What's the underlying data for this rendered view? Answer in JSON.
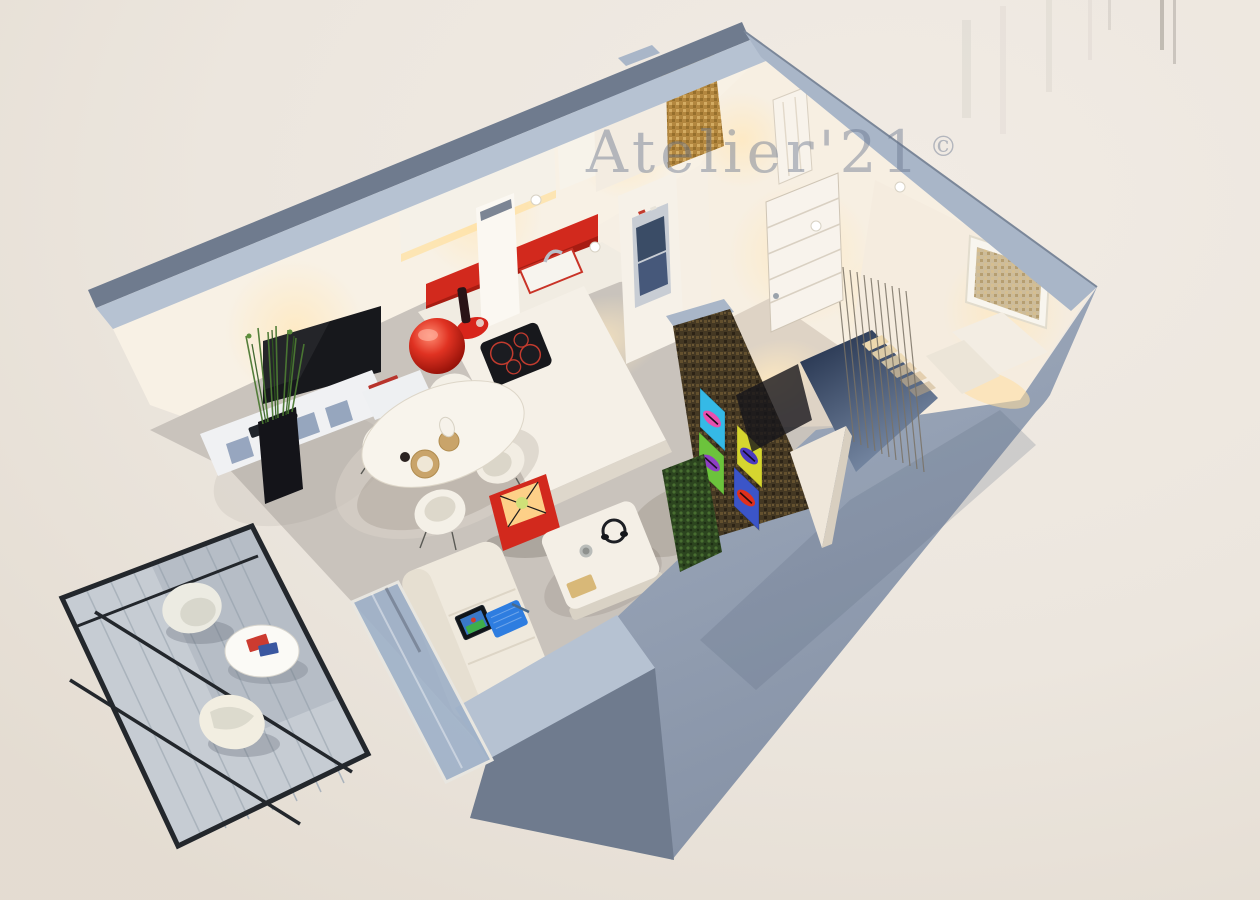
{
  "meta": {
    "type": "3d-apartment-floor-plan-render",
    "view": "axonometric-cutaway-top-down"
  },
  "watermark": {
    "text": "Atelier'21",
    "symbol": "©"
  },
  "palette": {
    "background": "#ede7df",
    "wall_top": "#a9b6c8",
    "wall_top_light": "#b6c2d2",
    "wall_gray": "#96a2b4",
    "wall_exterior": "#6f7b8e",
    "interior_wall": "#f6efe4",
    "floor": "#c9c3bc",
    "floor_warm": "#ded3c5",
    "accent_red": "#d2291d",
    "tv_black": "#17181c",
    "mosaic_gold": "#b3873f",
    "feature_wall": "#443823",
    "green_wall": "#2c451f",
    "stair_dark": "#26344e",
    "glass": "#9db0c8",
    "laptop_blue": "#2e7de0",
    "balcony_frame": "#23272c",
    "balcony_deck": "#c6ccd3",
    "watermark": "rgba(104,117,141,0.45)"
  },
  "art": {
    "name": "pop-art-lips-quadriptych",
    "lips_panels": [
      {
        "bg": "#35b9e6",
        "lips": "#e84fae"
      },
      {
        "bg": "#d6d52f",
        "lips": "#4b39c0"
      },
      {
        "bg": "#6cc33c",
        "lips": "#8e3fc4"
      },
      {
        "bg": "#3b55c8",
        "lips": "#e0301c"
      }
    ]
  },
  "apartment": {
    "rooms": [
      {
        "name": "kitchen",
        "features": [
          "white-upper-cabinets",
          "red-backsplash",
          "sink-with-chrome-faucet",
          "white-chimney-hood",
          "built-in-oven",
          "induction-cooktop",
          "island-counter",
          "red-ball-pendant-lamp",
          "wine-bottle-and-tray",
          "ceiling-spotlights"
        ]
      },
      {
        "name": "living-dining",
        "features": [
          "wall-mounted-tv",
          "white-media-console",
          "espresso-set",
          "books",
          "reed-plant-black-planter",
          "oval-dining-table",
          "four-white-shell-chairs",
          "place-settings",
          "red-cube-floor-lamp",
          "white-sofa",
          "laptop",
          "pen",
          "white-coffee-table",
          "headphones",
          "mug",
          "gold-notebook"
        ]
      },
      {
        "name": "bathroom",
        "features": [
          "gold-mosaic-shower-wall",
          "white-partition-walls",
          "white-door"
        ]
      },
      {
        "name": "entry-hall",
        "features": [
          "white-entrance-door",
          "chrome-door-handle",
          "vertical-decorative-rods",
          "staircase-going-down",
          "stair-balusters",
          "framed-artwork",
          "white-angular-console",
          "warm-spotlight-glow"
        ]
      },
      {
        "name": "balcony",
        "features": [
          "black-metal-railing",
          "diagonal-braces",
          "plank-decking",
          "two-white-shell-chairs",
          "round-side-table",
          "magazines",
          "glass-balcony-door"
        ]
      }
    ],
    "feature_wall": {
      "finish": "dark-bronze-mosaic",
      "art": "pop-art-lips-quadriptych",
      "side_panel": "vertical-garden-green-wall"
    }
  }
}
